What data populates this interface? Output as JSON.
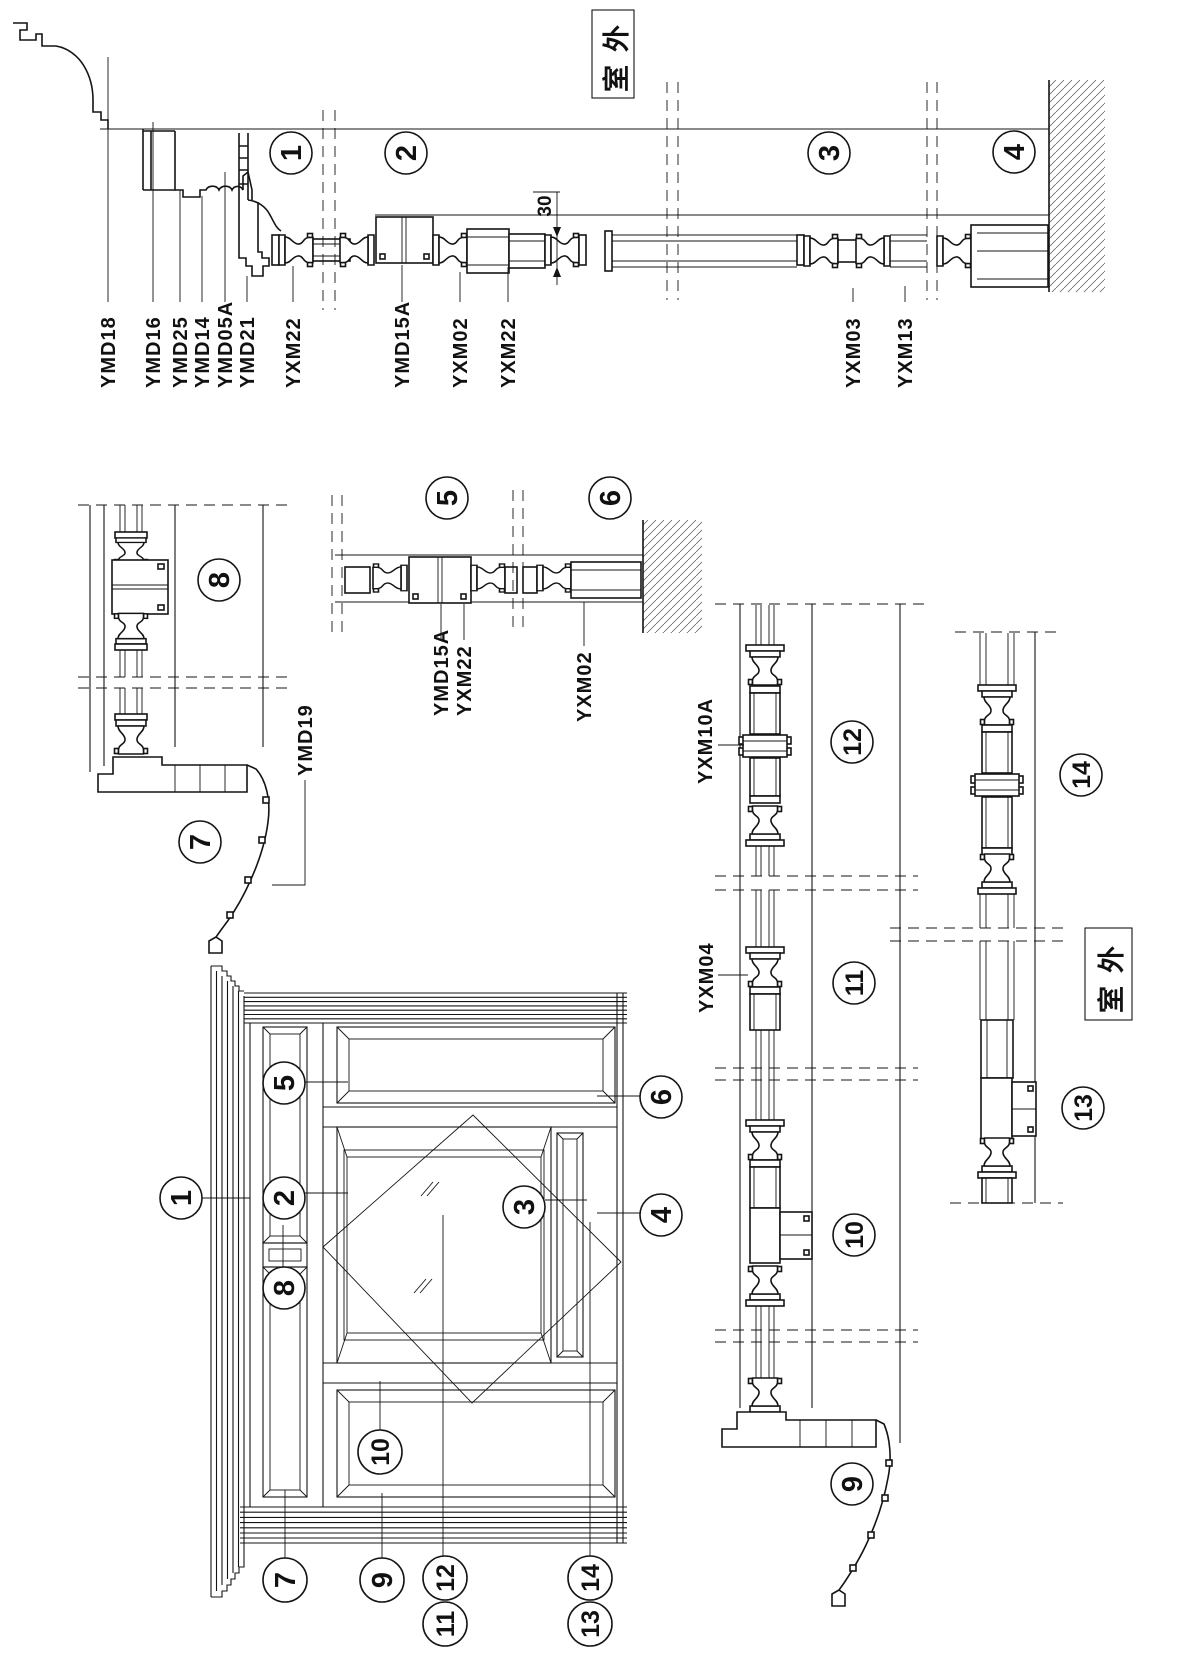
{
  "drawing": {
    "outdoor_label": "室外",
    "dimension_30": "30",
    "callouts": {
      "n1": "1",
      "n2": "2",
      "n3": "3",
      "n4": "4",
      "n5": "5",
      "n6": "6",
      "n7": "7",
      "n8": "8",
      "n9": "9",
      "n10": "10",
      "n11": "11",
      "n12": "12",
      "n13": "13",
      "n14": "14"
    },
    "parts": {
      "ymd18": "YMD18",
      "ymd16": "YMD16",
      "ymd25": "YMD25",
      "ymd14": "YMD14",
      "ymd05a": "YMD05A",
      "ymd21": "YMD21",
      "yxm22": "YXM22",
      "ymd15a": "YMD15A",
      "yxm02": "YXM02",
      "yxm03": "YXM03",
      "yxm13": "YXM13",
      "ymd19": "YMD19",
      "yxm10a": "YXM10A",
      "yxm04": "YXM04"
    }
  }
}
